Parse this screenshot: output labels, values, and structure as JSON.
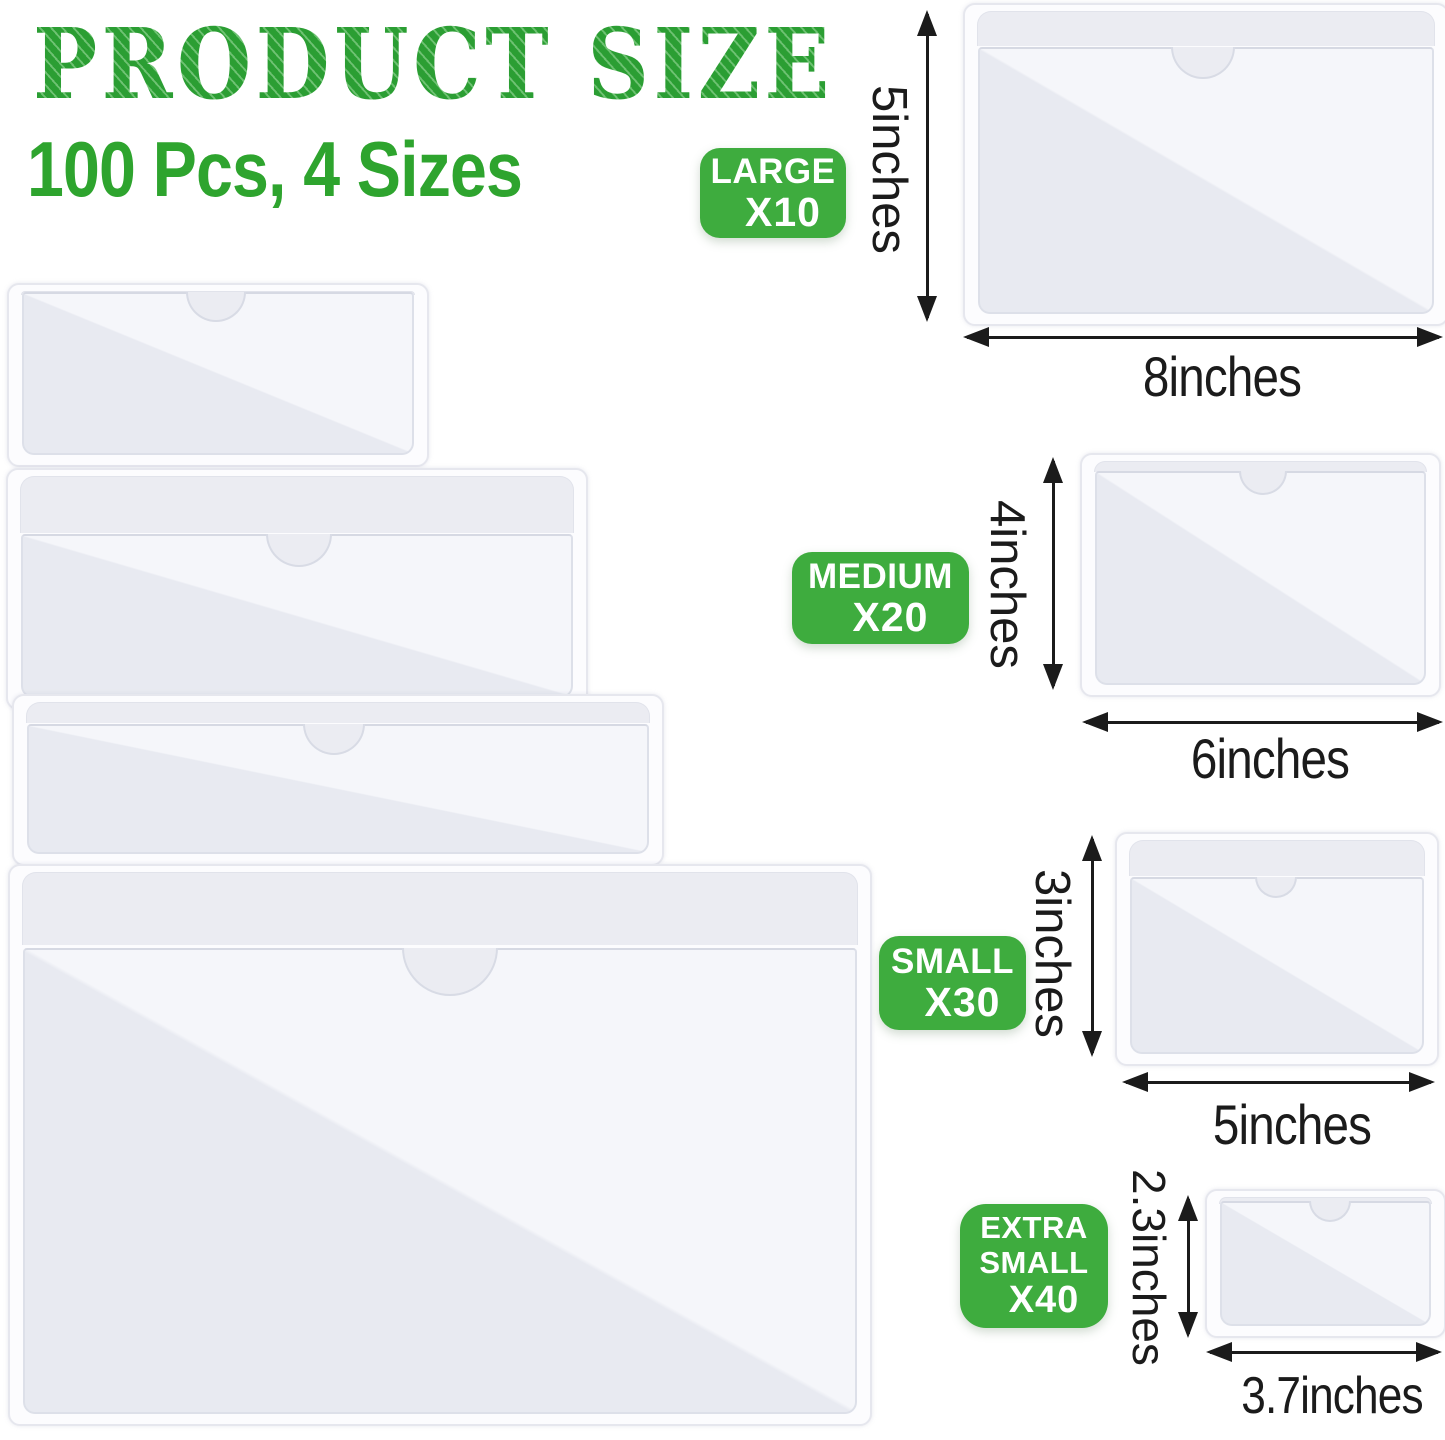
{
  "header": {
    "title": "PRODUCT SIZE",
    "subtitle": "100 Pcs, 4 Sizes"
  },
  "sizes": [
    {
      "label_lines": [
        "LARGE"
      ],
      "count": "X10",
      "height": "5inches",
      "width": "8inches"
    },
    {
      "label_lines": [
        "MEDIUM"
      ],
      "count": "X20",
      "height": "4inches",
      "width": "6inches"
    },
    {
      "label_lines": [
        "SMALL"
      ],
      "count": "X30",
      "height": "3inches",
      "width": "5inches"
    },
    {
      "label_lines": [
        "EXTRA",
        "SMALL"
      ],
      "count": "X40",
      "height": "2.3inches",
      "width": "3.7inches"
    }
  ],
  "colors": {
    "accent_green": "#2EA42E",
    "badge_green": "#3EAC3E",
    "dimension_ink": "#1B1B1B"
  }
}
